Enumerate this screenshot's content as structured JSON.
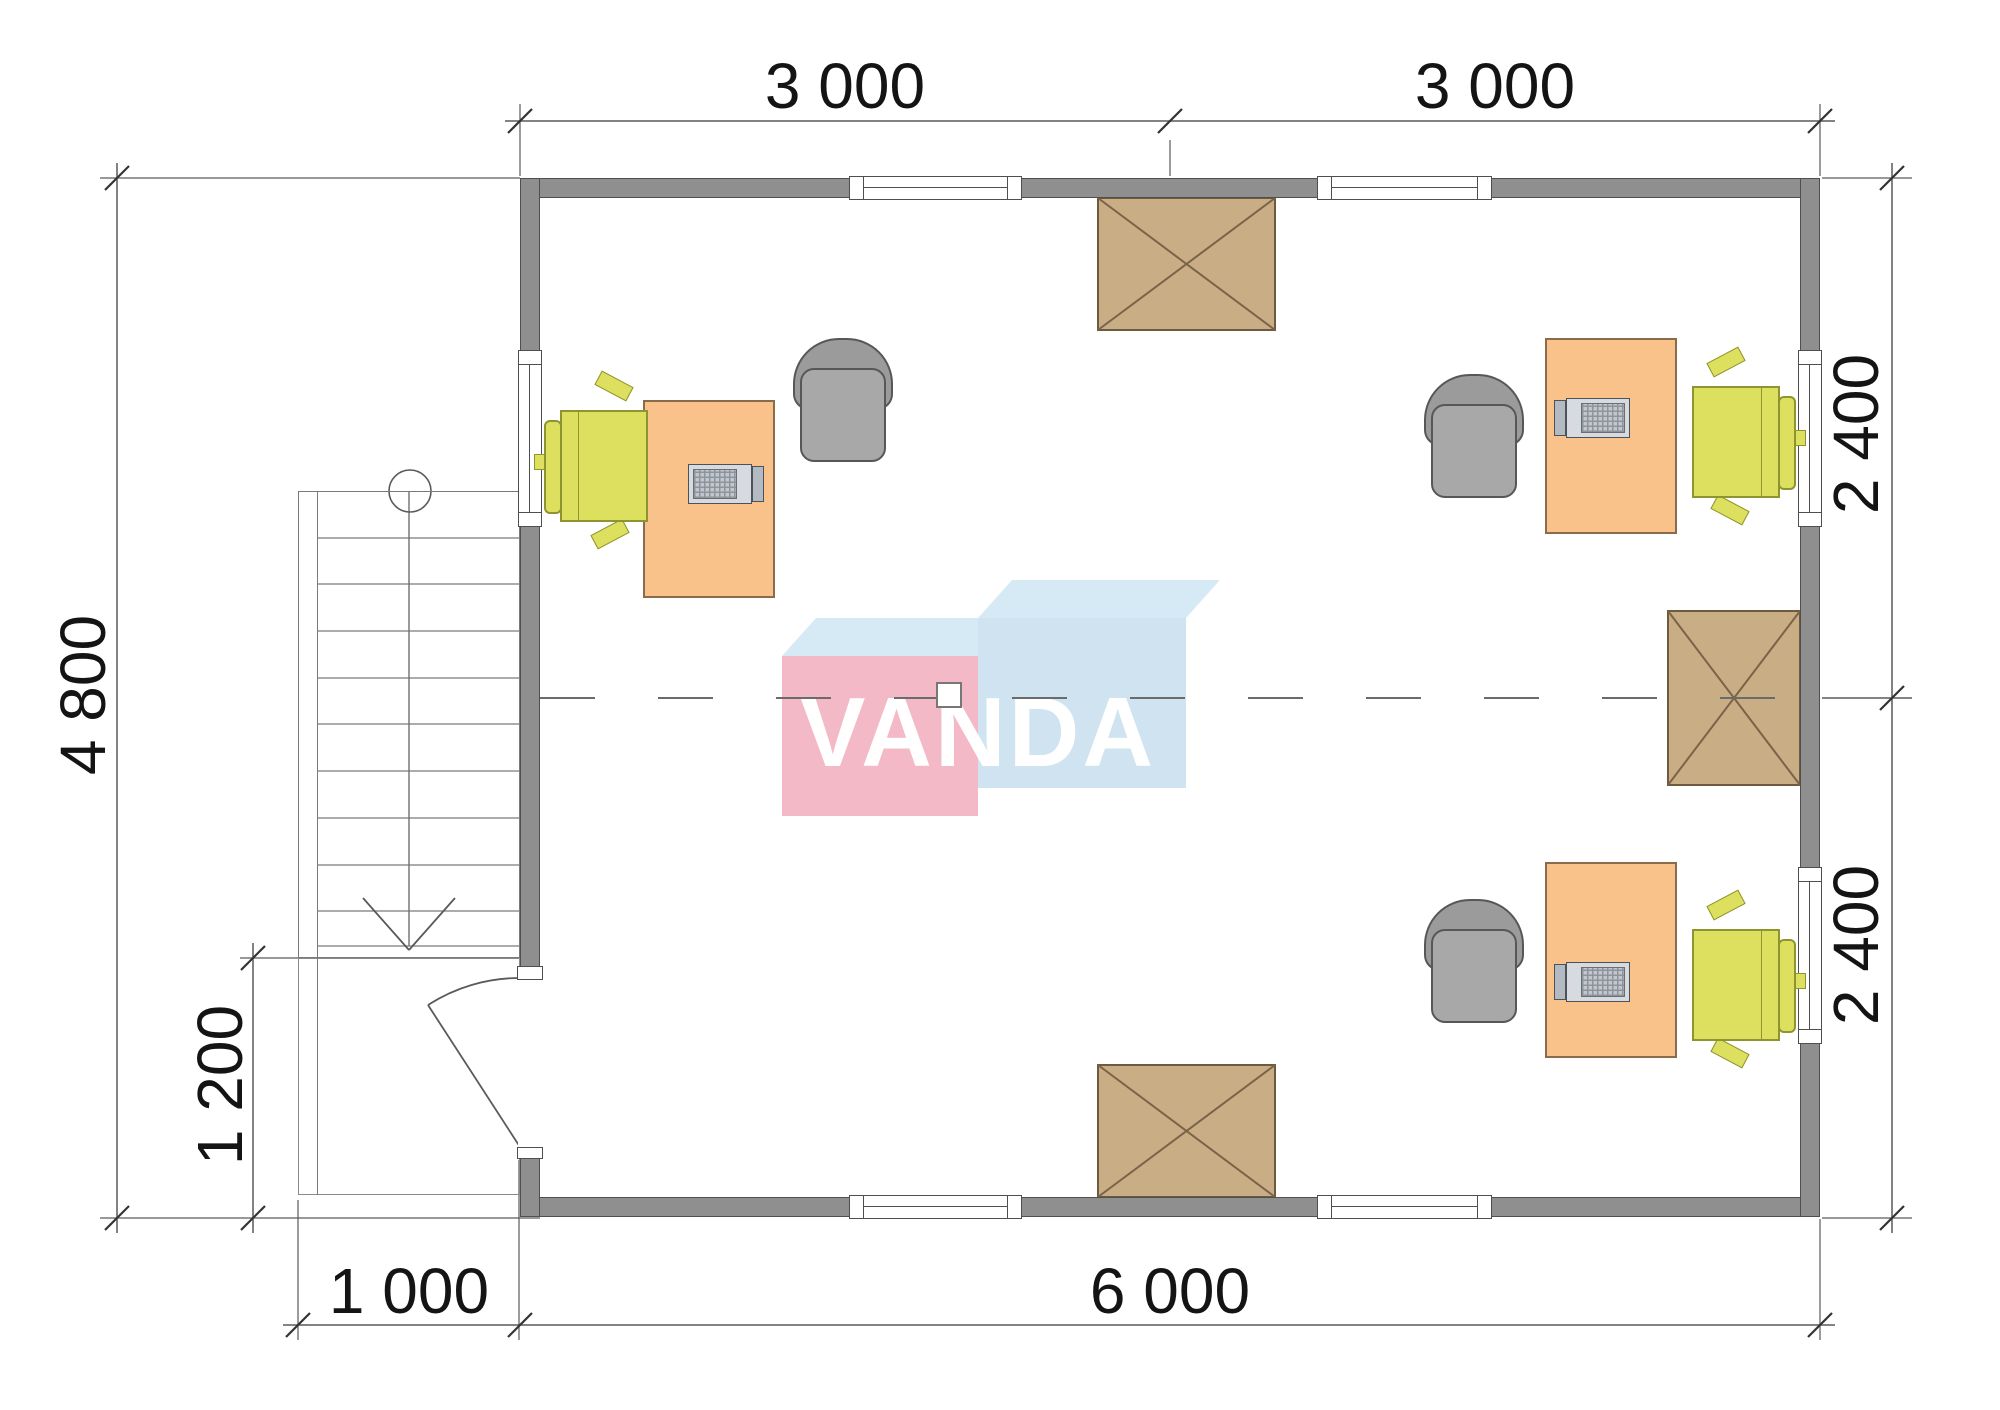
{
  "title": "Office floor plan",
  "watermark": {
    "text": "VANDA"
  },
  "dimensions": {
    "top": [
      {
        "label": "3 000"
      },
      {
        "label": "3 000"
      }
    ],
    "bottom": [
      {
        "label": "1 000"
      },
      {
        "label": "6 000"
      }
    ],
    "left": [
      {
        "label": "4 800"
      },
      {
        "label": "1 200"
      }
    ],
    "right": [
      {
        "label": "2 400"
      },
      {
        "label": "2 400"
      }
    ]
  },
  "plan": {
    "overall_mm": {
      "width": 6000,
      "depth": 4800
    },
    "top_modules_mm": [
      3000,
      3000
    ],
    "right_modules_mm": [
      2400,
      2400
    ],
    "porch_mm": {
      "width": 1000,
      "depth": 1200
    },
    "windows": {
      "top": 2,
      "bottom": 2,
      "left": 1,
      "right": 2
    },
    "rooms": [
      "open office"
    ],
    "furniture": {
      "workstations": 3,
      "desks": 3,
      "task_chairs": 3,
      "armchairs": 3,
      "laptops": 3,
      "hatched_boxes": 3,
      "staircase": 1,
      "entrance_door": 1
    }
  },
  "colors": {
    "wall": "#8f8f8f",
    "desk": "#f9c28b",
    "task_chair": "#dde05e",
    "armchair": "#a0a0a0",
    "hatch_box": "#c9ae85",
    "logo_pink": "#f4b9c7",
    "logo_blue_front": "#cfe3f0",
    "logo_blue_top": "#d6eaf6",
    "dimension_text": "#141414"
  }
}
